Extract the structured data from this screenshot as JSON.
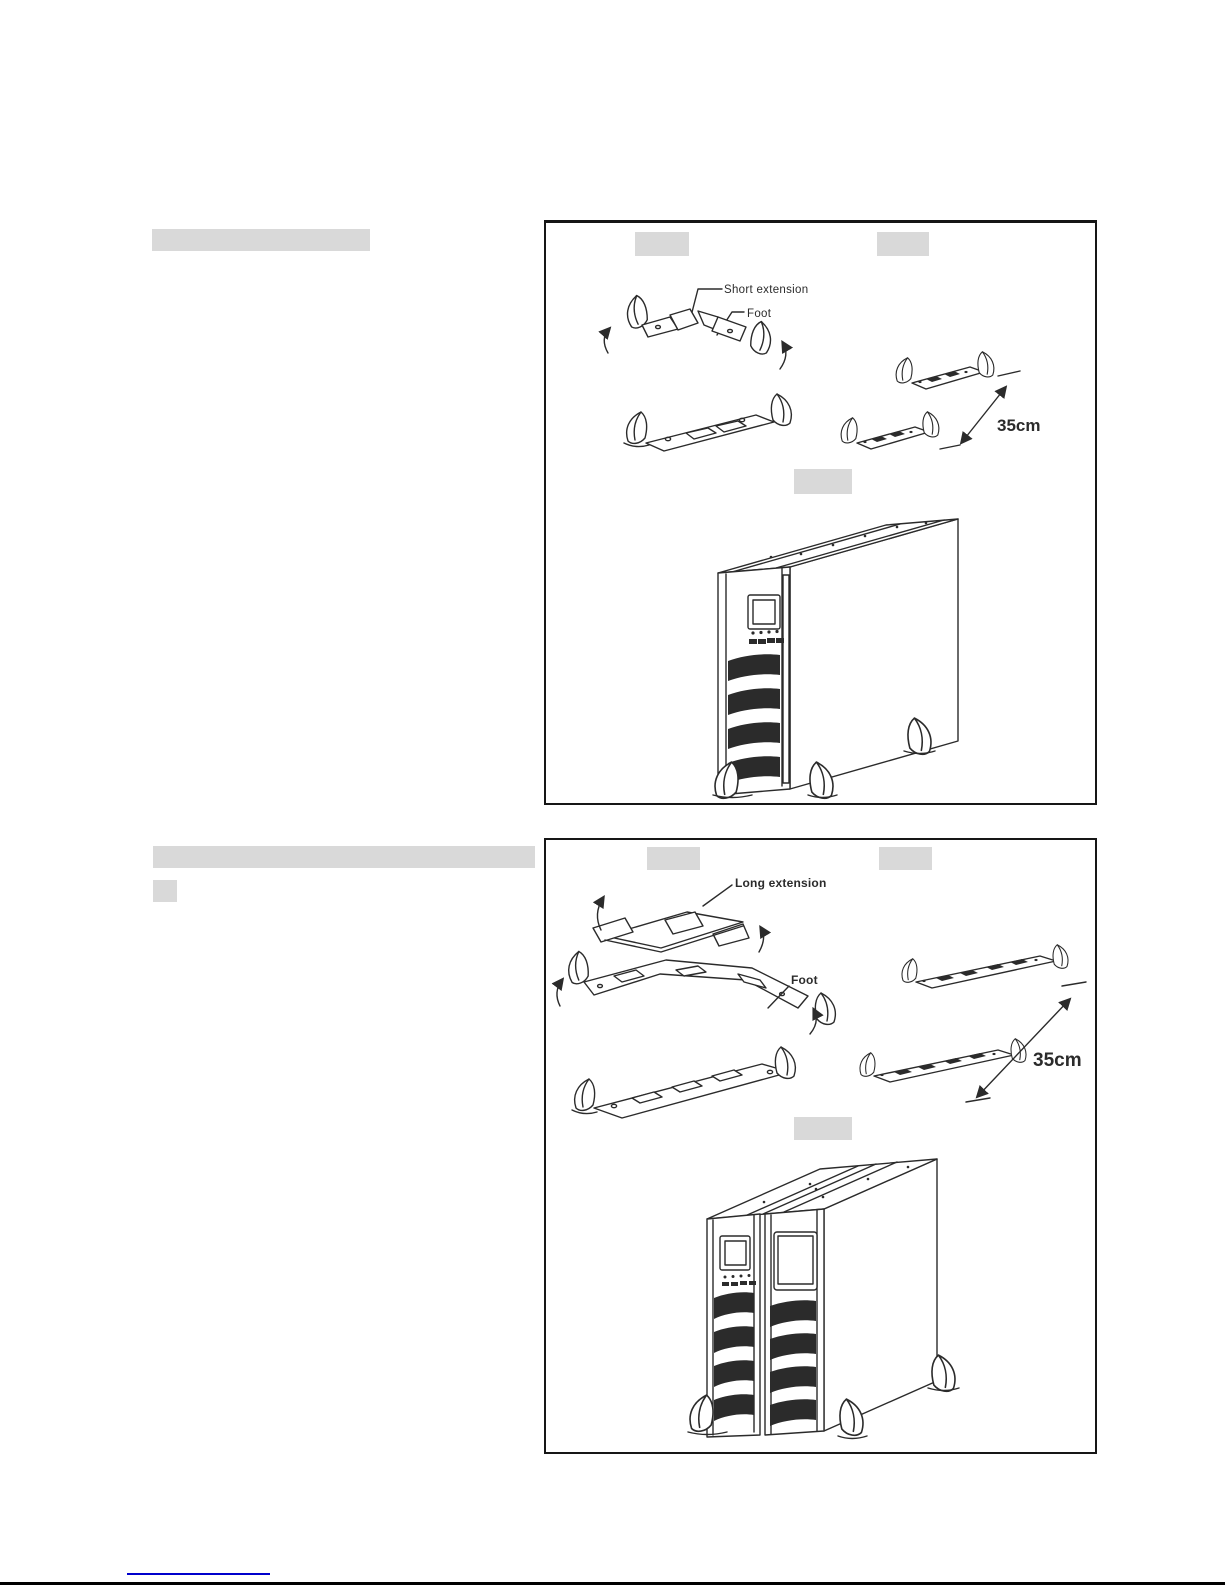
{
  "colors": {
    "line": "#2b2b2b",
    "redaction": "#d9d9d9",
    "link": "#0000cc"
  },
  "figure1": {
    "label_short_extension": "Short extension",
    "label_foot": "Foot",
    "label_distance": "35cm"
  },
  "figure2": {
    "label_long_extension": "Long extension",
    "label_foot": "Foot",
    "label_distance": "35cm"
  }
}
